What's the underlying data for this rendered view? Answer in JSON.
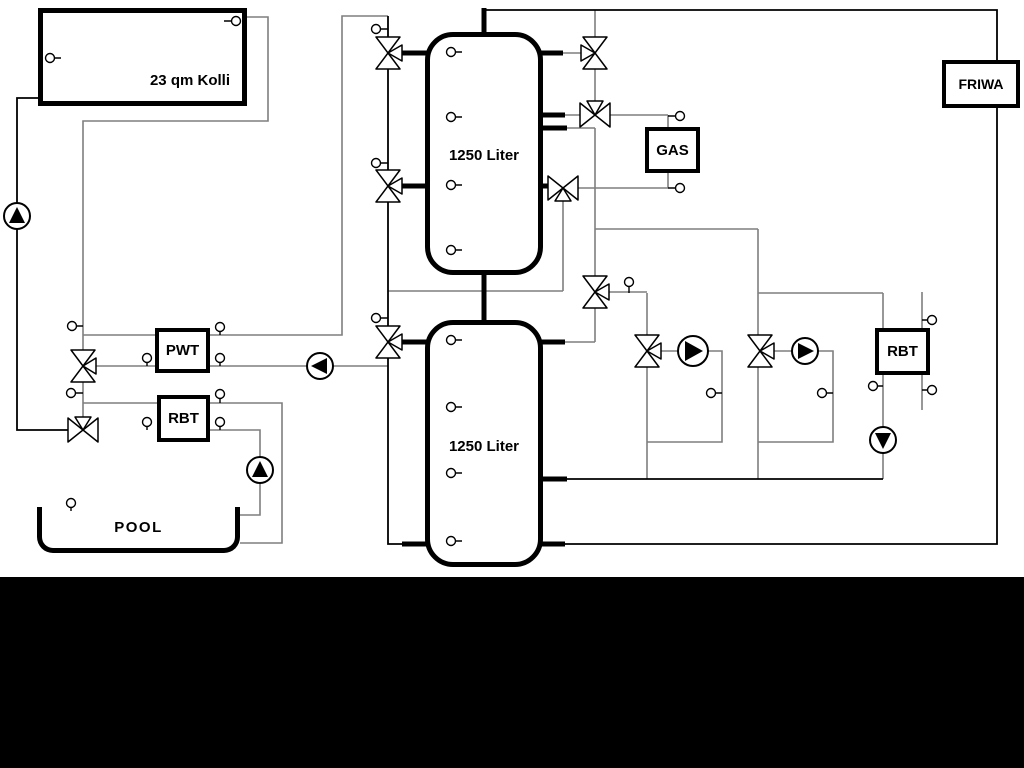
{
  "diagram": {
    "collector": {
      "label": "23 qm Kolli"
    },
    "tank_top": {
      "label": "1250 Liter"
    },
    "tank_bottom": {
      "label": "1250 Liter"
    },
    "gas_boiler": {
      "label": "GAS"
    },
    "fresh_water_station": {
      "label": "FRIWA"
    },
    "pwt_heat_exchanger": {
      "label": "PWT"
    },
    "rbt_pool_heat_exchanger": {
      "label": "RBT"
    },
    "rbt_right_heat_exchanger": {
      "label": "RBT"
    },
    "pool": {
      "label": "POOL"
    }
  },
  "colors": {
    "pipe_gray": "#7f7f7f",
    "pipe_black": "#000000",
    "background": "#ffffff",
    "footer_band": "#000000"
  }
}
